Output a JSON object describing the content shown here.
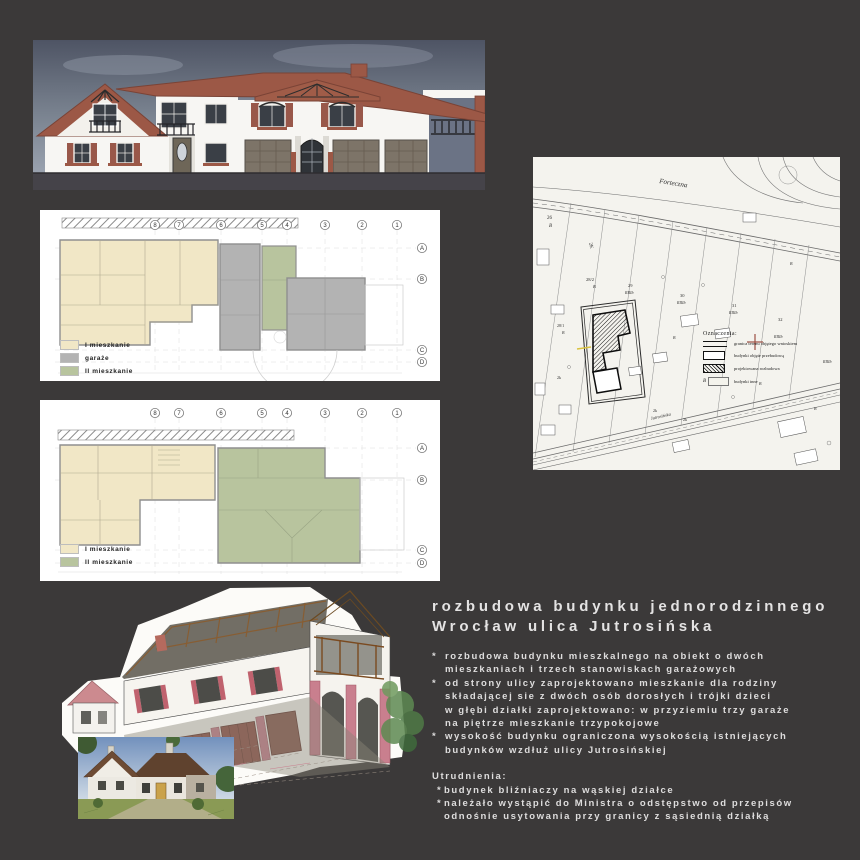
{
  "board": {
    "background": "#3b3939",
    "palette": {
      "roof": "#9c5846",
      "wall": "#f7f6f3",
      "shutter": "#99584a",
      "sky": "#5d6373",
      "apartment1_cream": "#f1e7c6",
      "garage_gray": "#b3b3b3",
      "apartment2_green": "#b8c49e",
      "map_paper": "#f4f3ee",
      "text": "#e4e3e3"
    }
  },
  "project_text": {
    "title_line1": "rozbudowa budynku jednorodzinnego",
    "title_line2": "Wrocław ulica Jutrosińska",
    "bullet_marker": "*",
    "bullets": [
      {
        "lines": [
          "rozbudowa budynku mieszkalnego na obiekt o dwóch",
          "mieszkaniach i trzech stanowiskach garażowych"
        ]
      },
      {
        "lines": [
          "od strony ulicy zaprojektowano mieszkanie dla rodziny",
          "składającej sie z dwóch osób dorosłych i trójki dzieci",
          "w głębi działki zaprojektowano: w przyziemiu trzy garaże",
          "na piętrze mieszkanie trzypokojowe"
        ]
      },
      {
        "lines": [
          "wysokość budynku ograniczona wysokością istniejących",
          "budynków wzdłuż ulicy Jutrosińskiej"
        ]
      }
    ],
    "difficulties_header": "Utrudnienia:",
    "difficulties": [
      {
        "lines": [
          "budynek bliźniaczy na wąskiej działce"
        ]
      },
      {
        "lines": [
          "należało wystąpić do Ministra o odstępstwo od przepisów",
          "odnośnie usytowania przy granicy z sąsiednią działką"
        ]
      }
    ]
  },
  "floor_plan_1": {
    "grid": [
      {
        "x": 115,
        "y": 15,
        "label": "8"
      },
      {
        "x": 139,
        "y": 15,
        "label": "7"
      },
      {
        "x": 181,
        "y": 15,
        "label": "6"
      },
      {
        "x": 222,
        "y": 15,
        "label": "5"
      },
      {
        "x": 247,
        "y": 15,
        "label": "4"
      },
      {
        "x": 285,
        "y": 15,
        "label": "3"
      },
      {
        "x": 322,
        "y": 15,
        "label": "2"
      },
      {
        "x": 357,
        "y": 15,
        "label": "1"
      },
      {
        "x": 382,
        "y": 38,
        "label": "A"
      },
      {
        "x": 382,
        "y": 69,
        "label": "B"
      },
      {
        "x": 382,
        "y": 140,
        "label": "C"
      },
      {
        "x": 382,
        "y": 152,
        "label": "D"
      }
    ],
    "legend": [
      {
        "color": "#f1e7c6",
        "label": "I mieszkanie"
      },
      {
        "color": "#b3b3b3",
        "label": "garaże"
      },
      {
        "color": "#b8c49e",
        "label": "II mieszkanie"
      }
    ]
  },
  "floor_plan_2": {
    "grid": [
      {
        "x": 115,
        "y": 13,
        "label": "8"
      },
      {
        "x": 139,
        "y": 13,
        "label": "7"
      },
      {
        "x": 181,
        "y": 13,
        "label": "6"
      },
      {
        "x": 222,
        "y": 13,
        "label": "5"
      },
      {
        "x": 247,
        "y": 13,
        "label": "4"
      },
      {
        "x": 285,
        "y": 13,
        "label": "3"
      },
      {
        "x": 322,
        "y": 13,
        "label": "2"
      },
      {
        "x": 357,
        "y": 13,
        "label": "1"
      },
      {
        "x": 382,
        "y": 48,
        "label": "A"
      },
      {
        "x": 382,
        "y": 80,
        "label": "B"
      },
      {
        "x": 382,
        "y": 150,
        "label": "C"
      },
      {
        "x": 382,
        "y": 163,
        "label": "D"
      }
    ],
    "legend": [
      {
        "color": "#f1e7c6",
        "label": "I mieszkanie"
      },
      {
        "color": "#b8c49e",
        "label": "II mieszkanie"
      }
    ]
  },
  "site_plan": {
    "legend_title": "Oznaczenia:",
    "legend": [
      {
        "symbol": "double-line",
        "b": "",
        "label": "granica terenu objętego wnioskiem"
      },
      {
        "symbol": "outline-rect",
        "b": "",
        "label": "budynki objęte przebudową"
      },
      {
        "symbol": "hatched-rect",
        "b": "",
        "label": "projektowana rozbudowa"
      },
      {
        "symbol": "light-rect",
        "b": "B",
        "label": "budynki inne"
      }
    ],
    "labels": [
      {
        "x": 126,
        "y": 26,
        "t": "Forteczna",
        "s": 7,
        "r": 9,
        "i": 1
      },
      {
        "x": 14,
        "y": 62,
        "t": "26",
        "s": 5
      },
      {
        "x": 16,
        "y": 70,
        "t": "B",
        "s": 5,
        "i": 1
      },
      {
        "x": 56,
        "y": 86,
        "t": "2K",
        "s": 5,
        "r": 75
      },
      {
        "x": 53,
        "y": 124,
        "t": "28/2",
        "s": 4.5
      },
      {
        "x": 60,
        "y": 131,
        "t": "B",
        "s": 4.5,
        "i": 1
      },
      {
        "x": 24,
        "y": 170,
        "t": "28/1",
        "s": 4
      },
      {
        "x": 29,
        "y": 177,
        "t": "B",
        "s": 4,
        "i": 1
      },
      {
        "x": 95,
        "y": 130,
        "t": "29",
        "s": 4.5
      },
      {
        "x": 92,
        "y": 137,
        "t": "RIIIb",
        "s": 4,
        "i": 1
      },
      {
        "x": 147,
        "y": 140,
        "t": "30",
        "s": 4.5
      },
      {
        "x": 144,
        "y": 147,
        "t": "RIIIb",
        "s": 4,
        "i": 1
      },
      {
        "x": 199,
        "y": 150,
        "t": "31",
        "s": 4.5
      },
      {
        "x": 196,
        "y": 157,
        "t": "RIIIb",
        "s": 4,
        "i": 1
      },
      {
        "x": 245,
        "y": 164,
        "t": "32",
        "s": 4.5
      },
      {
        "x": 241,
        "y": 181,
        "t": "RIIIb",
        "s": 4,
        "i": 1
      },
      {
        "x": 290,
        "y": 206,
        "t": "RIIIb",
        "s": 4,
        "i": 1
      },
      {
        "x": 24,
        "y": 222,
        "t": "2k",
        "s": 4
      },
      {
        "x": 120,
        "y": 255,
        "t": "2k",
        "s": 4
      },
      {
        "x": 150,
        "y": 264,
        "t": "2k",
        "s": 4
      },
      {
        "x": 140,
        "y": 182,
        "t": "B",
        "s": 4,
        "i": 1
      },
      {
        "x": 226,
        "y": 228,
        "t": "B",
        "s": 4,
        "i": 1
      },
      {
        "x": 281,
        "y": 253,
        "t": "B",
        "s": 4,
        "i": 1
      },
      {
        "x": 257,
        "y": 108,
        "t": "B",
        "s": 4,
        "i": 1
      },
      {
        "x": 118,
        "y": 263,
        "t": "Jutrosińska",
        "s": 4.5,
        "r": -13,
        "i": 1
      }
    ]
  }
}
